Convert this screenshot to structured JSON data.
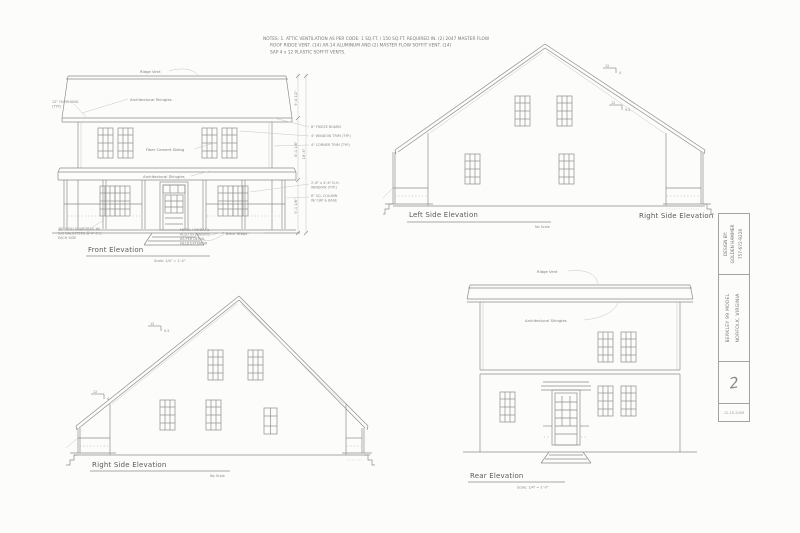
{
  "sheet": {
    "notes_line1": "NOTES:  1. ATTIC VENTILATION AS PER CODE: 1 SQ.FT. / 150 SQ.FT. REQUIRED IN. (2) 2047 MASTER  FLOW",
    "notes_line2": "ROOF RIDGE VENT. (14) AR-14 ALUMINUM AND (2) MASTER FLOW SOFFIT VENT. (14)",
    "notes_line3": "SAP 4 x 12 PLASTIC SOFFIT VENTS."
  },
  "front": {
    "title": "Front Elevation",
    "scale": "Scale: 1/4\" = 1'-0\"",
    "ridge_vent": "Ridge Vent",
    "shingles": "Architectural Shingles",
    "siding": "Fiber Cement Siding",
    "porch_shingles": "Architectural Shingles",
    "brick_steps": "Brick Steps",
    "overhang_note1": "12\" OVERHANG",
    "overhang_note2": "(TYP.)",
    "rail_note1": "36\" HIGH GUARDRAIL W/",
    "rail_note2": "2x2 BALUSTERS @ 4\" O.C.",
    "rail_note3": "EACH SIDE",
    "hand_note1": "METAL HANDRAIL",
    "hand_note2": "ALSO IN LANDING",
    "hand_note3": "AS PER DETAIL",
    "hand_note4": "HELD EXTERIOR",
    "note_frieze": "8\" FRIEZE BOARD",
    "note_wtrim": "4\" WINDOW TRIM (TYP.)",
    "note_ctrim": "4\" CORNER TRIM (TYP.)",
    "note_window1": "2'-8\" x 4'-6\" D.H.",
    "note_window2": "WINDOW (TYP.)",
    "note_column1": "8\" SQ. COLUMN",
    "note_column2": "W/ CAP & BASE",
    "dim_roof": "9'-4 1/2\"",
    "dim_second": "8'-1 1/8\"",
    "dim_first": "9'-1 1/8\"",
    "dim_total": "18'-5\""
  },
  "left_side": {
    "title": "Left Side Elevation",
    "scale": "No Scale",
    "pitch1_run": "12",
    "pitch1_rise": "4",
    "pitch2_run": "12",
    "pitch2_rise": "9.5"
  },
  "right_side_top": {
    "title": "Right Side Elevation"
  },
  "right_side": {
    "title": "Right Side Elevation",
    "scale": "No Scale",
    "pitch1_run": "12",
    "pitch1_rise": "9.5",
    "pitch2_run": "12",
    "pitch2_rise": "4"
  },
  "rear": {
    "title": "Rear Elevation",
    "scale": "Scale: 1/4\" = 1'-0\"",
    "ridge_vent": "Ridge Vent",
    "shingles": "Architectural Shingles"
  },
  "title_block": {
    "designed_by": "DESIGN BY:",
    "company": "GOLDEN HAMMER",
    "phone": "757-672-9220",
    "project": "BERKLEY 99 MODEL",
    "location": "NORFOLK, VIRGINIA",
    "sheet_number": "2",
    "date": "12-10-2009"
  }
}
